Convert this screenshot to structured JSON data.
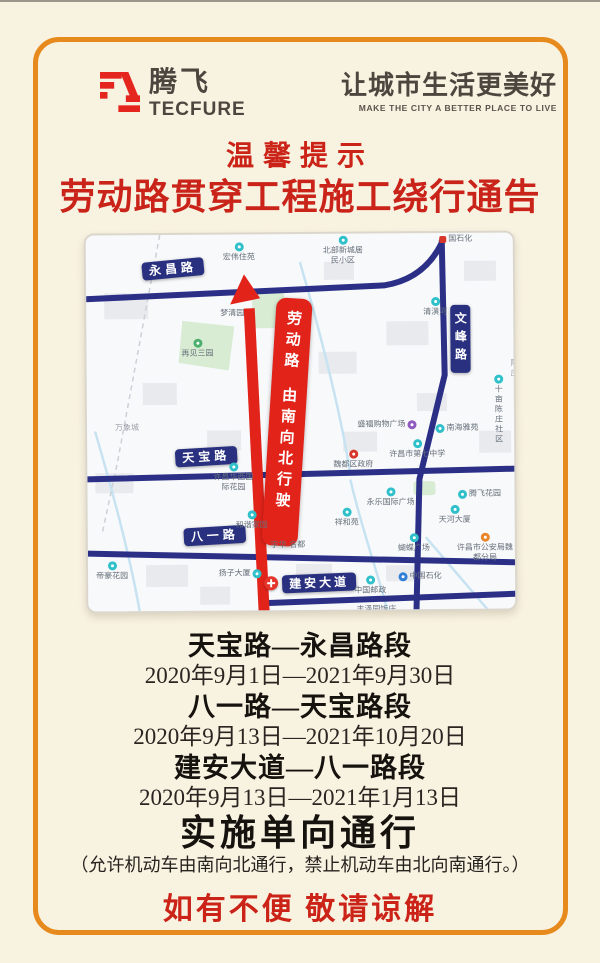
{
  "brand": {
    "logo_cn": "腾飞",
    "logo_en": "TECFURE",
    "slogan_cn": "让城市生活更美好",
    "slogan_en": "MAKE THE CITY A BETTER PLACE TO LIVE"
  },
  "notice": {
    "tip": "温馨提示",
    "title": "劳动路贯穿工程施工绕行通告"
  },
  "map": {
    "road_badges": {
      "yongchang": "永昌路",
      "wenfeng": "文峰路",
      "tianbao": "天宝路",
      "bayi": "八一路",
      "jianan": "建安大道"
    },
    "route_label": {
      "road": "劳动路",
      "direction": "由南向北行驶"
    },
    "pois": [
      {
        "label": "宏伟住苑"
      },
      {
        "label": "北部新城居民小区"
      },
      {
        "label": "国石化"
      },
      {
        "label": "梦清园"
      },
      {
        "label": "再见三园"
      },
      {
        "label": "万象城"
      },
      {
        "label": "清潩河"
      },
      {
        "label": "十亩陈庄社区"
      },
      {
        "label": "陈庄"
      },
      {
        "label": "盛福购物广场"
      },
      {
        "label": "南海雅苑"
      },
      {
        "label": "许昌市第七中学"
      },
      {
        "label": "魏都区政府"
      },
      {
        "label": "许昌华西国际花园"
      },
      {
        "label": "永乐国际广场"
      },
      {
        "label": "腾飞花园"
      },
      {
        "label": "祥和苑"
      },
      {
        "label": "和谐家园"
      },
      {
        "label": "天河大厦"
      },
      {
        "label": "宇华·名都"
      },
      {
        "label": "蝴蝶广场"
      },
      {
        "label": "许昌市公安局魏都分局"
      },
      {
        "label": "帝豪花园"
      },
      {
        "label": "扬子大厦"
      },
      {
        "label": "中国邮政"
      },
      {
        "label": "中国石化"
      },
      {
        "label": "丰泽园饭庄"
      }
    ]
  },
  "schedule": [
    {
      "section": "天宝路—永昌路段",
      "period": "2020年9月1日—2021年9月30日"
    },
    {
      "section": "八一路—天宝路段",
      "period": "2020年9月13日—2021年10月20日"
    },
    {
      "section": "建安大道—八一路段",
      "period": "2020年9月13日—2021年1月13日"
    }
  ],
  "policy": {
    "headline": "实施单向通行",
    "detail": "（允许机动车由南向北通行，禁止机动车由北向南通行。）",
    "apology": "如有不便 敬请谅解"
  },
  "colors": {
    "frame_orange": "#e78a1e",
    "accent_red": "#c9231a",
    "road_navy": "#2b3086",
    "route_red": "#e2231a",
    "background_cream": "#f8f2e1"
  }
}
